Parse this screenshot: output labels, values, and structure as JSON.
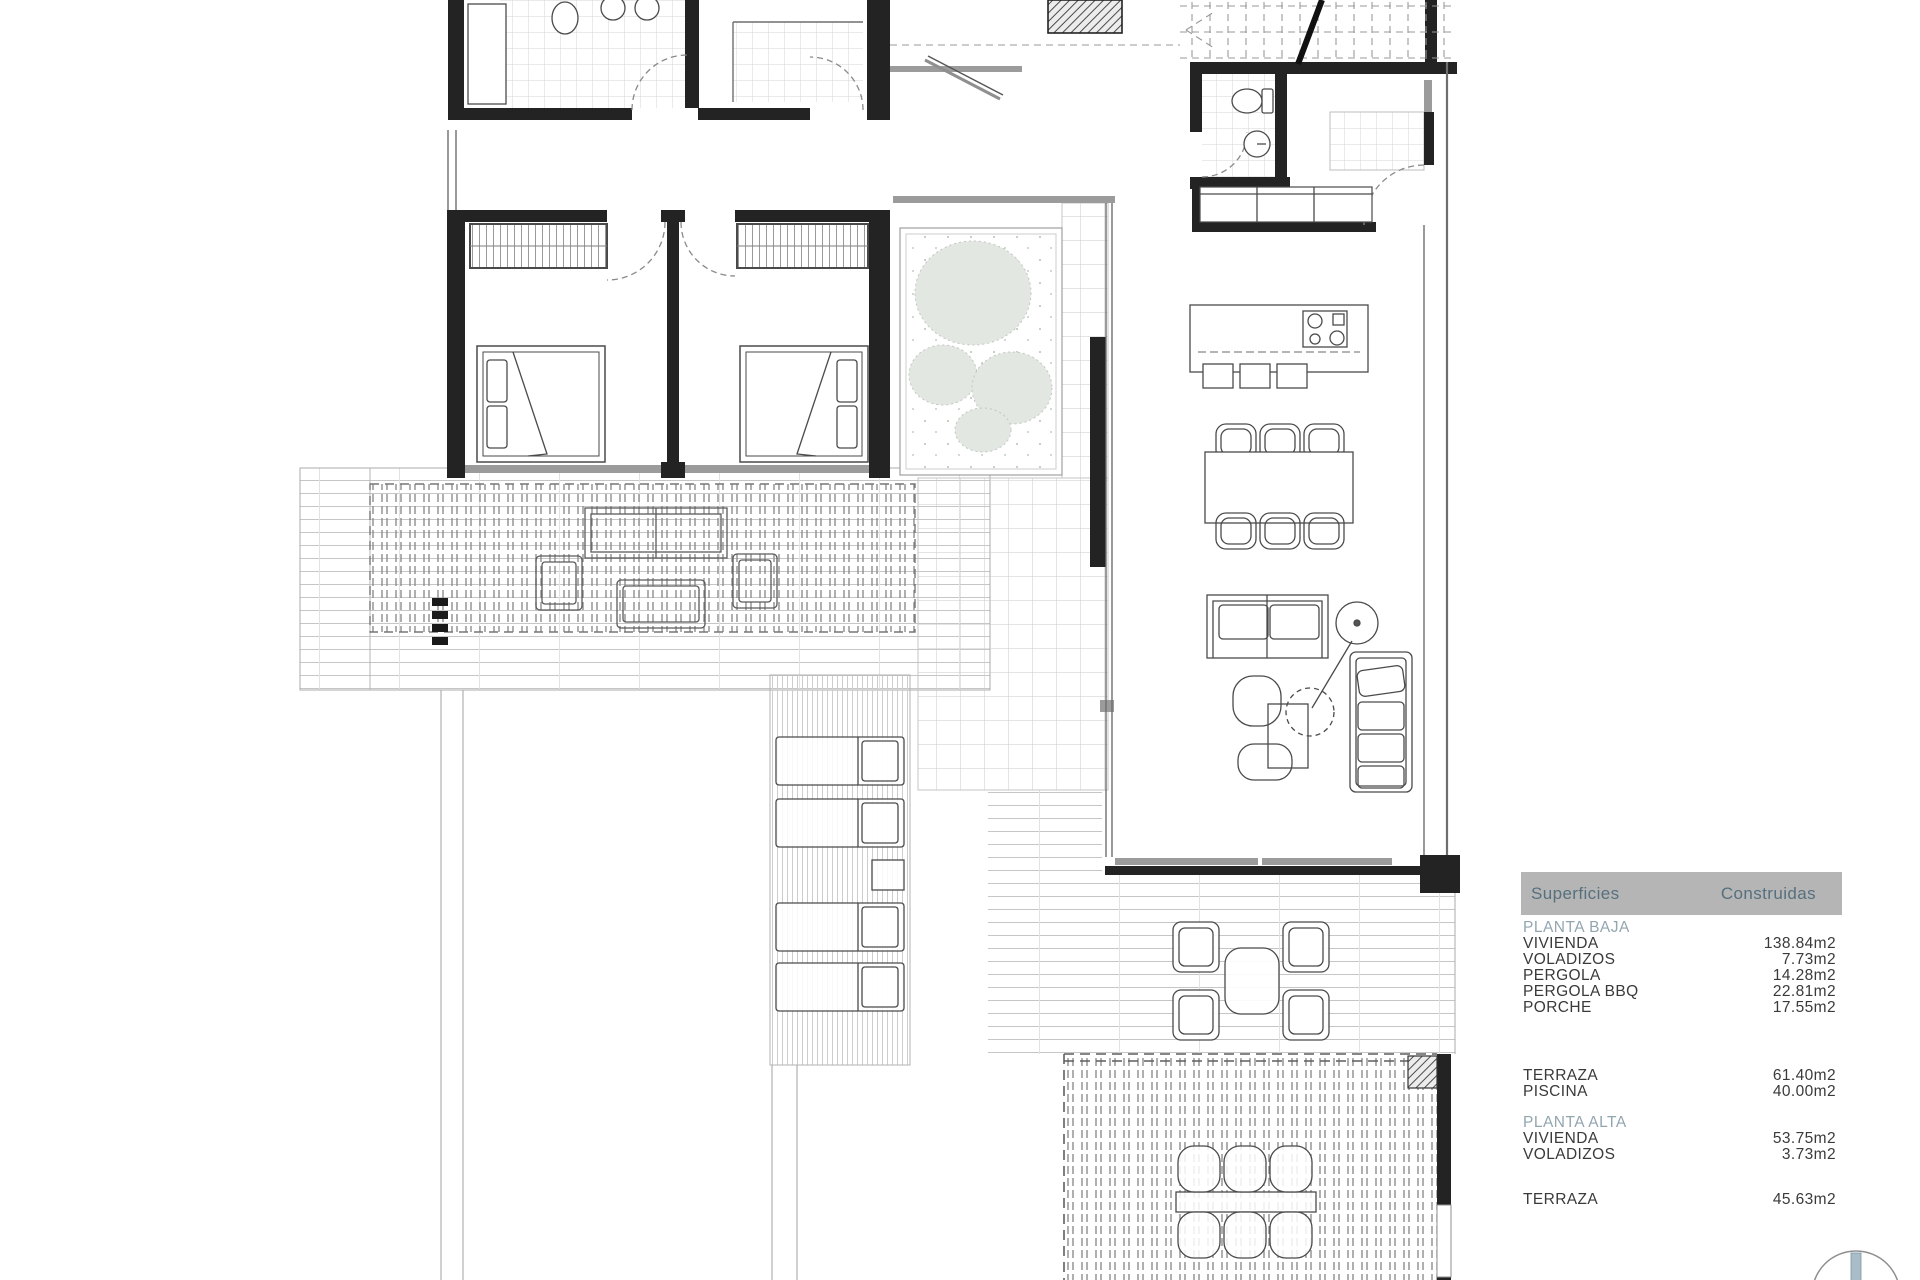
{
  "panel": {
    "header": {
      "col1": "Superficies",
      "col2": "Construidas"
    },
    "sections": [
      {
        "title": "PLANTA BAJA",
        "rows": [
          {
            "label": "VIVIENDA",
            "value": "138.84m2"
          },
          {
            "label": "VOLADIZOS",
            "value": "7.73m2"
          },
          {
            "label": "PERGOLA",
            "value": "14.28m2"
          },
          {
            "label": "PERGOLA BBQ",
            "value": "22.81m2"
          },
          {
            "label": "PORCHE",
            "value": "17.55m2"
          }
        ]
      },
      {
        "title": "",
        "rows": [
          {
            "label": "TERRAZA",
            "value": "61.40m2"
          },
          {
            "label": "PISCINA",
            "value": "40.00m2"
          }
        ]
      },
      {
        "title": "PLANTA ALTA",
        "rows": [
          {
            "label": "VIVIENDA",
            "value": "53.75m2"
          },
          {
            "label": "VOLADIZOS",
            "value": "3.73m2"
          }
        ]
      },
      {
        "title": "",
        "rows": [
          {
            "label": "TERRAZA",
            "value": "45.63m2"
          }
        ]
      }
    ]
  },
  "icons": {
    "north-arrow-icon": "circle-with-needle"
  },
  "colors": {
    "panel-header-bg": "#b5b5b5",
    "panel-header-text": "#56707e",
    "panel-section-text": "#93a6b0",
    "panel-row-text": "#3a3a3a"
  }
}
